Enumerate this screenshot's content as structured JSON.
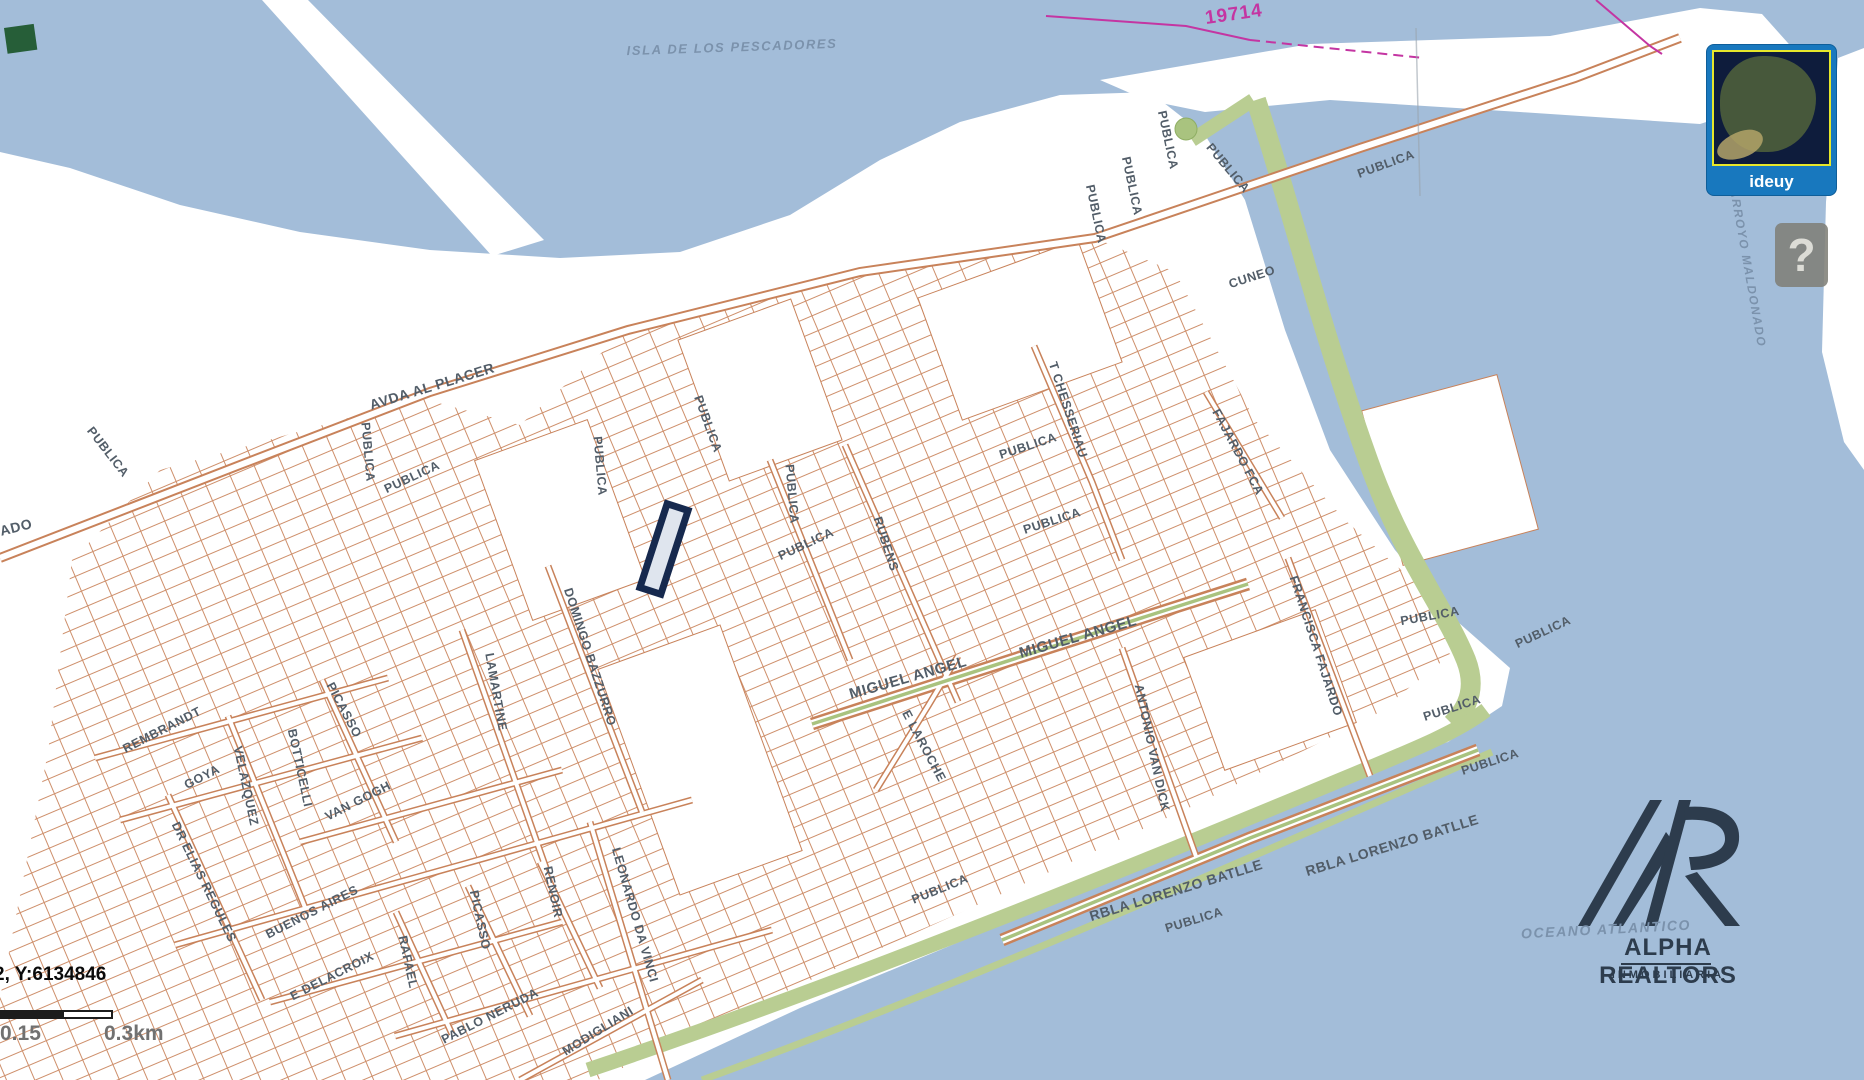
{
  "map": {
    "labels": [
      {
        "k": "water",
        "t": "ISLA DE LOS PESCADORES",
        "x": 732,
        "y": 47,
        "r": -2,
        "s": 13
      },
      {
        "k": "water",
        "t": "ARROYO MALDONADO",
        "x": 1748,
        "y": 268,
        "r": 80,
        "s": 12
      },
      {
        "k": "water",
        "t": "OCEANO ATLANTICO",
        "x": 1606,
        "y": 929,
        "r": -3,
        "s": 14
      },
      {
        "k": "boundary",
        "t": "19714",
        "x": 1234,
        "y": 15,
        "r": -8,
        "s": 19
      },
      {
        "t": "AVDA AL PLACER",
        "x": 432,
        "y": 386,
        "r": -17,
        "s": 14
      },
      {
        "t": "PUBLICA",
        "x": 368,
        "y": 452,
        "r": 85
      },
      {
        "t": "PUBLICA",
        "x": 412,
        "y": 477,
        "r": -25
      },
      {
        "t": "PUBLICA",
        "x": 108,
        "y": 452,
        "r": 52
      },
      {
        "t": "ADO",
        "x": 16,
        "y": 527,
        "r": -14,
        "s": 14
      },
      {
        "t": "PUBLICA",
        "x": 600,
        "y": 466,
        "r": 85
      },
      {
        "t": "PUBLICA",
        "x": 708,
        "y": 424,
        "r": 70
      },
      {
        "t": "PUBLICA",
        "x": 1168,
        "y": 140,
        "r": 78
      },
      {
        "t": "PUBLICA",
        "x": 1132,
        "y": 186,
        "r": 78
      },
      {
        "t": "PUBLICA",
        "x": 1096,
        "y": 214,
        "r": 78
      },
      {
        "t": "PUBLICA",
        "x": 1228,
        "y": 168,
        "r": 50
      },
      {
        "t": "PUBLICA",
        "x": 1386,
        "y": 164,
        "r": -20
      },
      {
        "t": "CUNEO",
        "x": 1252,
        "y": 277,
        "r": -18
      },
      {
        "t": "T CHESSERIAU",
        "x": 1068,
        "y": 410,
        "r": 72
      },
      {
        "t": "PUBLICA",
        "x": 1028,
        "y": 446,
        "r": -18
      },
      {
        "t": "PUBLICA",
        "x": 1052,
        "y": 521,
        "r": -18
      },
      {
        "t": "FAJARDO FCA",
        "x": 1238,
        "y": 452,
        "r": 62
      },
      {
        "t": "PUBLICA",
        "x": 792,
        "y": 494,
        "r": 85
      },
      {
        "t": "PUBLICA",
        "x": 806,
        "y": 544,
        "r": -25
      },
      {
        "t": "RUBENS",
        "x": 886,
        "y": 544,
        "r": 72
      },
      {
        "t": "MIGUEL ANGEL",
        "x": 908,
        "y": 678,
        "r": -16,
        "s": 15
      },
      {
        "t": "MIGUEL ANGEL",
        "x": 1078,
        "y": 637,
        "r": -16,
        "s": 15
      },
      {
        "t": "E LAROCHE",
        "x": 924,
        "y": 746,
        "r": 62
      },
      {
        "t": "ANTONIO VAN DICK",
        "x": 1152,
        "y": 748,
        "r": 78
      },
      {
        "t": "PUBLICA",
        "x": 940,
        "y": 889,
        "r": -22
      },
      {
        "t": "FRANCISCA FAJARDO",
        "x": 1316,
        "y": 646,
        "r": 72
      },
      {
        "t": "PUBLICA",
        "x": 1430,
        "y": 616,
        "r": -10
      },
      {
        "t": "PUBLICA",
        "x": 1543,
        "y": 632,
        "r": -25
      },
      {
        "t": "PUBLICA",
        "x": 1452,
        "y": 708,
        "r": -18
      },
      {
        "t": "PUBLICA",
        "x": 1490,
        "y": 762,
        "r": -18
      },
      {
        "t": "RBLA LORENZO BATLLE",
        "x": 1176,
        "y": 890,
        "r": -17,
        "s": 14
      },
      {
        "t": "RBLA LORENZO BATLLE",
        "x": 1392,
        "y": 845,
        "r": -17,
        "s": 14
      },
      {
        "t": "PUBLICA",
        "x": 1194,
        "y": 920,
        "r": -17
      },
      {
        "t": "REMBRANDT",
        "x": 162,
        "y": 730,
        "r": -27
      },
      {
        "t": "GOYA",
        "x": 202,
        "y": 777,
        "r": -27
      },
      {
        "t": "DR ELIAS REGULES",
        "x": 204,
        "y": 882,
        "r": 64
      },
      {
        "t": "VELAZQUEZ",
        "x": 246,
        "y": 786,
        "r": 78
      },
      {
        "t": "BOTTICELLI",
        "x": 300,
        "y": 768,
        "r": 78
      },
      {
        "t": "PICASSO",
        "x": 344,
        "y": 710,
        "r": 62
      },
      {
        "t": "VAN GOGH",
        "x": 358,
        "y": 801,
        "r": -27
      },
      {
        "t": "BUENOS AIRES",
        "x": 312,
        "y": 912,
        "r": -27
      },
      {
        "t": "E DELACROIX",
        "x": 332,
        "y": 976,
        "r": -27
      },
      {
        "t": "RAFAEL",
        "x": 408,
        "y": 962,
        "r": 78
      },
      {
        "t": "PICASSO",
        "x": 480,
        "y": 920,
        "r": 78
      },
      {
        "t": "RENOIR",
        "x": 553,
        "y": 892,
        "r": 78
      },
      {
        "t": "PABLO NERUDA",
        "x": 490,
        "y": 1016,
        "r": -27
      },
      {
        "t": "MODIGLIANI",
        "x": 598,
        "y": 1031,
        "r": -32
      },
      {
        "t": "LEONARDO DA VINCI",
        "x": 635,
        "y": 915,
        "r": 74
      },
      {
        "t": "LAMARTINE",
        "x": 496,
        "y": 692,
        "r": 80
      },
      {
        "t": "DOMINGO BAZZURRO",
        "x": 590,
        "y": 657,
        "r": 72
      }
    ]
  },
  "minimap": {
    "label": "ideuy"
  },
  "help": {
    "label": "?"
  },
  "status_bar": {
    "coordinates": "2, Y:6134846"
  },
  "scale_bar": {
    "mid_label": "0.15",
    "end_label": "0.3km"
  },
  "logo": {
    "title": "ALPHA REALTORS",
    "subtitle": "INMOBILIARIA"
  },
  "colors": {
    "water": "#a3bdd9",
    "land": "#ffffff",
    "parcel_line": "#c8825a",
    "green_area": "#b9cd92",
    "highlight_outline": "#16294e",
    "boundary_magenta": "#c435a2",
    "street_text": "#525d68",
    "water_text": "#7b92ac",
    "logo_navy": "#2d3c4d",
    "minimap_blue": "#1878be"
  }
}
